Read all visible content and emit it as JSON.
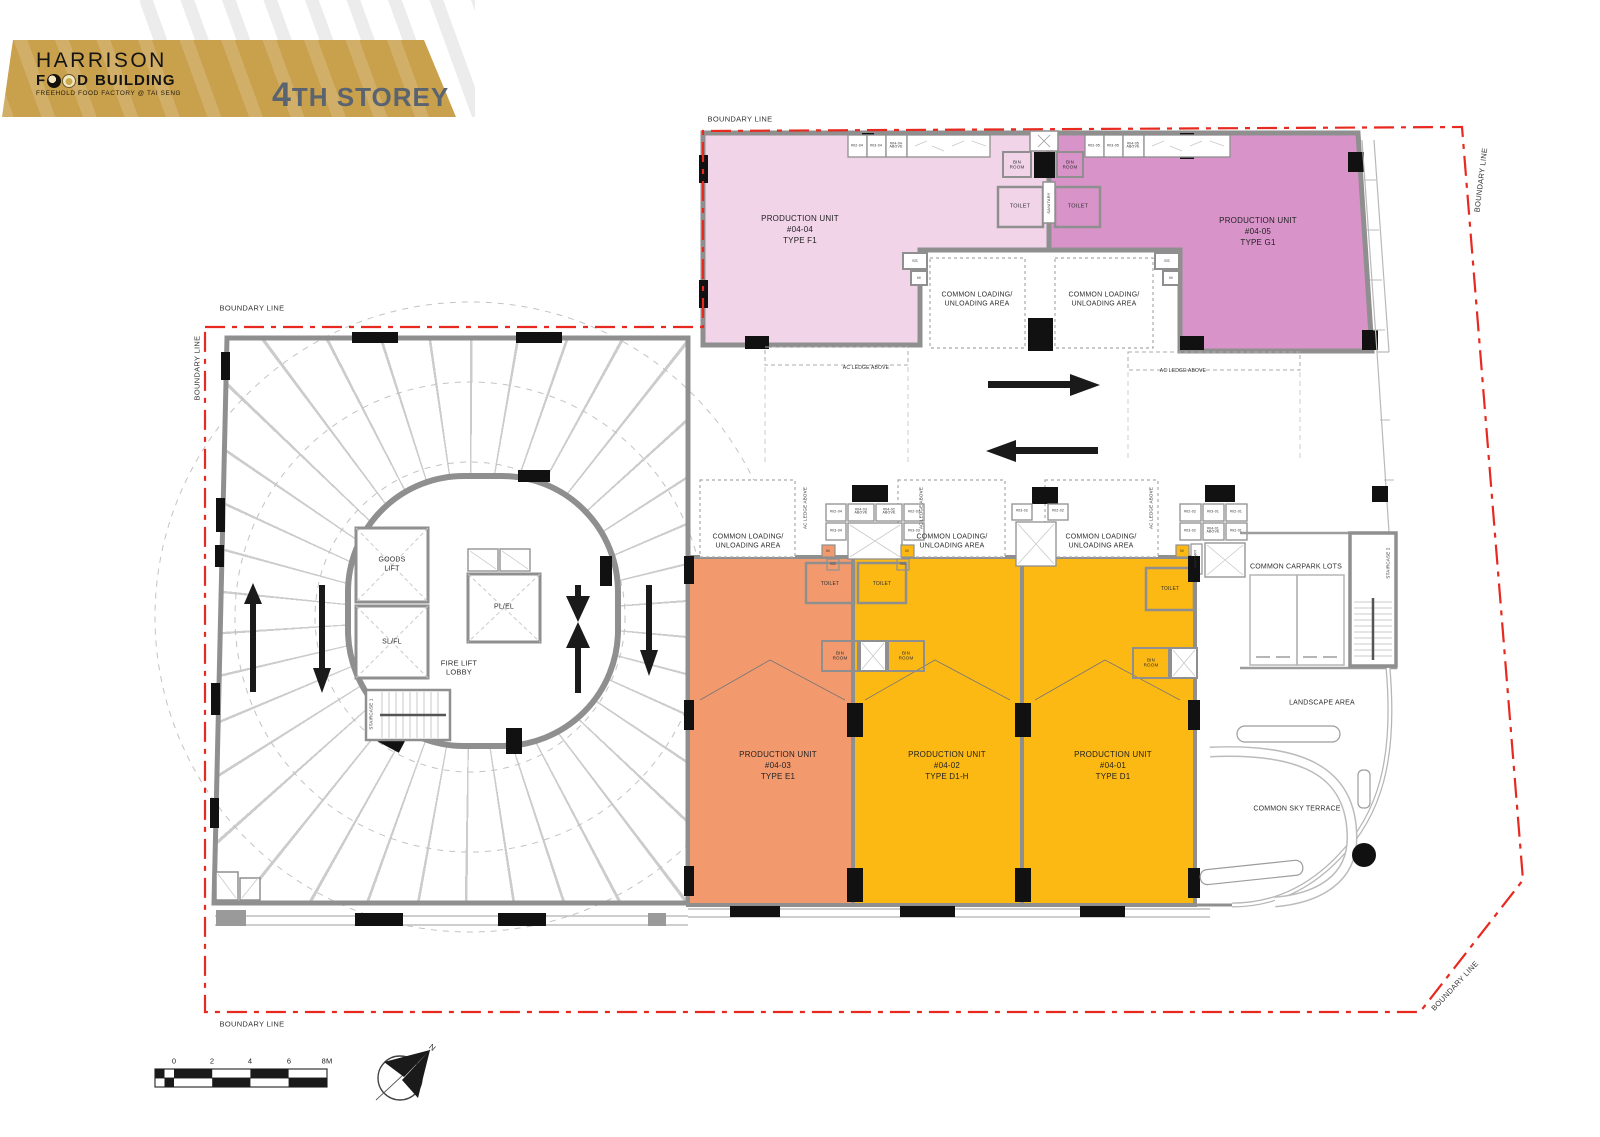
{
  "header": {
    "brand_top": "HARRISON",
    "brand_f": "F",
    "brand_d": "D",
    "brand_building": "BUILDING",
    "tagline": "FREEHOLD FOOD FACTORY @ TAI SENG",
    "storey": "4TH STOREY"
  },
  "colors": {
    "unit_f1": "#f2d4e9",
    "unit_g1": "#d893c9",
    "unit_e1": "#f29a6e",
    "unit_d1h": "#fdb913",
    "unit_d1": "#fdb913",
    "banner_gold": "#c9a04b",
    "boundary_red": "#e8291f"
  },
  "units": {
    "f1": {
      "name": "PRODUCTION UNIT",
      "no": "#04-04",
      "type": "TYPE F1"
    },
    "g1": {
      "name": "PRODUCTION UNIT",
      "no": "#04-05",
      "type": "TYPE G1"
    },
    "e1": {
      "name": "PRODUCTION UNIT",
      "no": "#04-03",
      "type": "TYPE E1"
    },
    "d1h": {
      "name": "PRODUCTION UNIT",
      "no": "#04-02",
      "type": "TYPE D1-H"
    },
    "d1": {
      "name": "PRODUCTION UNIT",
      "no": "#04-01",
      "type": "TYPE D1"
    }
  },
  "labels": {
    "boundary": "BOUNDARY LINE",
    "common_loading": "COMMON LOADING/\nUNLOADING AREA",
    "bin_room": "BIN\nROOM",
    "toilet": "TOILET",
    "sanitary": "SANITARY",
    "ac_ledge": "AC LEDGE ABOVE",
    "goods_lift": "GOODS\nLIFT",
    "sl_fl": "SL/FL",
    "pl_el": "PL/EL",
    "fire_lift_lobby": "FIRE LIFT\nLOBBY",
    "staircase_1": "STAIRCASE 1",
    "staircase_2": "STAIRCASE 2",
    "carpark": "COMMON CARPARK LOTS",
    "landscape": "LANDSCAPE AREA",
    "sky_terrace": "COMMON SKY TERRACE",
    "north": "N",
    "ss": "SS",
    "m": "M"
  },
  "shafts": {
    "top_left": [
      "#02-04",
      "#03-04",
      "#04-04\nABOVE"
    ],
    "top_right": [
      "#02-05",
      "#03-05",
      "#04-05\nABOVE"
    ],
    "mid_row1": [
      "#02-04",
      "#04-03\nABOVE",
      "#04-02\nABOVE",
      "#02-03"
    ],
    "mid_row2": [
      "#03-04",
      "#03-03"
    ],
    "right_row1": [
      "#02-02",
      "#03-01",
      "#02-01"
    ],
    "right_row2": [
      "#03-02",
      "#04-01\nABOVE",
      "#02-01"
    ],
    "pair": [
      "#03-02",
      "#02-02"
    ]
  },
  "scale_bar": {
    "ticks": [
      "0",
      "2",
      "4",
      "6",
      "8M"
    ]
  }
}
